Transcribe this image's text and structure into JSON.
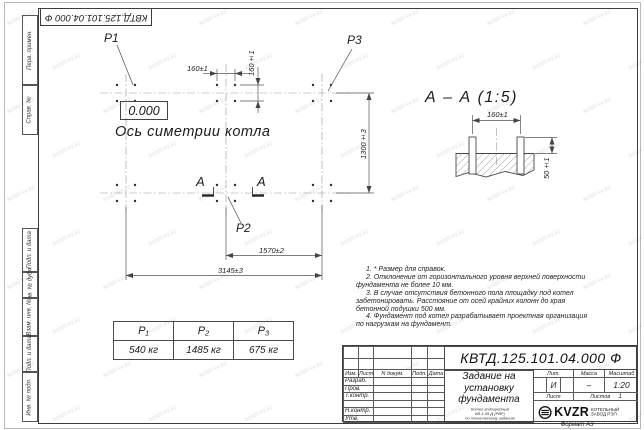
{
  "watermark": "kotel-kv.kz",
  "stamp_top": "КВТД.125.101.04.000 Ф",
  "side_labels": [
    "Перв. примен.",
    "Справ. №",
    "Подп. и дата",
    "Инв. № дубл.",
    "Взам. инв. №",
    "Подп. и дата",
    "Инв. № подл."
  ],
  "plan": {
    "p1": "P1",
    "p2": "P2",
    "p3": "P3",
    "elevation": "0.000",
    "axis_label": "Ось симетрии котла",
    "section_letter": "А",
    "dims": {
      "bolt_h": "160±1",
      "bolt_v": "160±1",
      "width_half": "1570±2",
      "width_full": "3145±3",
      "depth": "1300±3"
    }
  },
  "section_view": {
    "title": "А – А (1:5)",
    "dims": {
      "bolt_spacing": "160±1",
      "protrusion": "50±1"
    }
  },
  "notes": [
    "1. * Размер для справок.",
    "2. Отклонение от горизонтального уровня верхней поверхности фундамента не более 10 мм.",
    "3. В случае отсутствия бетонного пола площадку под котел забетонировать. Расстояние от осей крайних колонн до края бетонной подушки 500 мм.",
    "4. Фундамент под котел разрабатывает проектная организация по нагрузкам на фундамент."
  ],
  "load_table": {
    "headers": [
      "P₁",
      "P₂",
      "P₃"
    ],
    "values": [
      "540 кг",
      "1485 кг",
      "675 кг"
    ]
  },
  "title_block": {
    "doc_number": "КВТД.125.101.04.000 Ф",
    "title_lines": [
      "Задание на",
      "установку",
      "фундамента"
    ],
    "subtitle_lines": [
      "Котел водогрейный",
      "КВ-1,45 Д (РВР)",
      "по техническому заданию"
    ],
    "change_header": [
      "Изм.",
      "Лист",
      "N докум.",
      "Подп.",
      "Дата"
    ],
    "role_rows": [
      "Разраб.",
      "Пров.",
      "Т.контр.",
      "",
      "Н.контр.",
      "Утв."
    ],
    "lit_label": "Лит.",
    "lit_value": "И",
    "mass_label": "Масса",
    "mass_value": "–",
    "scale_label": "Масштаб",
    "scale_value": "1:20",
    "sheet_label": "Лист",
    "sheets_label": "Листов",
    "sheets_value": "1",
    "brand": "KVZR",
    "brand_lines": [
      "КОТЕЛЬНЫЙ",
      "ЗАВОД РЭП"
    ],
    "format_label": "Формат А3"
  }
}
